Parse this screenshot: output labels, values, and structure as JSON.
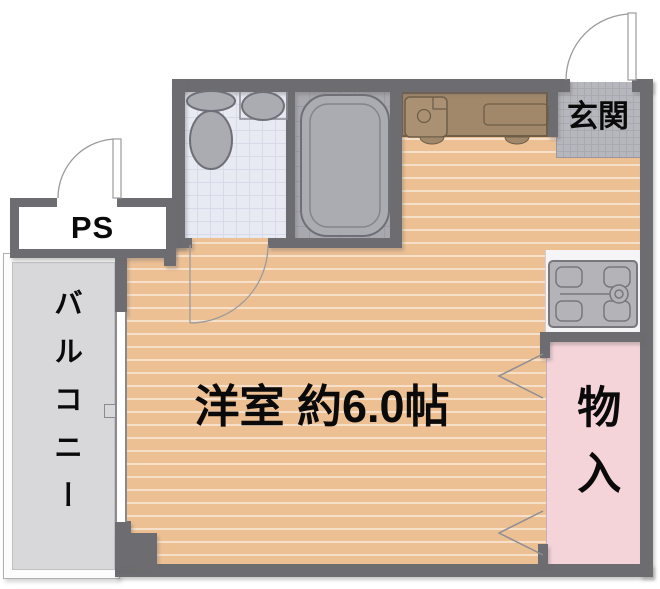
{
  "plan": {
    "rooms": {
      "main_room": {
        "label": "洋室 約6.0帖"
      },
      "entrance": {
        "label": "玄関"
      },
      "pipe_shaft": {
        "label": "PS"
      },
      "balcony": {
        "label": "バルコニー"
      },
      "storage": {
        "label": "物入"
      }
    },
    "fixtures": [
      {
        "name": "toilet-icon"
      },
      {
        "name": "wash-basin-icon"
      },
      {
        "name": "bathtub-icon"
      },
      {
        "name": "kitchen-sink-icon"
      },
      {
        "name": "stove-icon"
      },
      {
        "name": "washing-machine-pan-icon"
      }
    ],
    "colors": {
      "wall": "#6d6d71",
      "floor": "#edc094",
      "floor_stripe": "#f7ddc0",
      "washroom_floor": "#e7e9f3",
      "bath_floor": "#a8a8af",
      "genkan_tile": "#b6b7bc",
      "balcony": "#d8d8da",
      "storage": "#f5d4d9",
      "kitchen_counter": "#a2886a",
      "fixture_fill": "#abacb2",
      "fixture_stroke": "#6f6f77"
    }
  }
}
